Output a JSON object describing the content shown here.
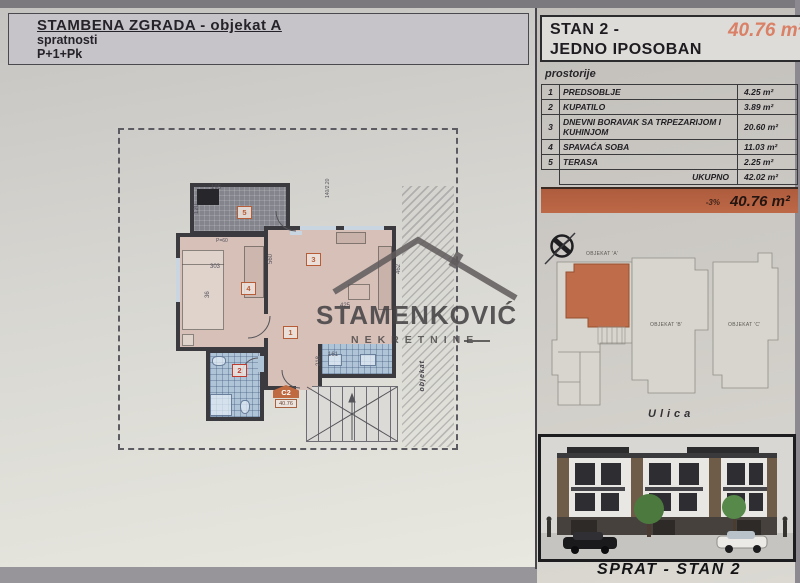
{
  "header": {
    "title": "STAMBENA ZGRADA - objekat A",
    "subtitle": "spratnosti",
    "floors": "P+1+Pk"
  },
  "unit_panel": {
    "title_line1": "STAN 2 -",
    "title_line2": "JEDNO IPOSOBAN",
    "area_highlight": "40.76 m²",
    "section_label": "prostorije",
    "rooms": [
      {
        "num": "1",
        "name": "PREDSOBLJE",
        "area": "4.25 m²"
      },
      {
        "num": "2",
        "name": "KUPATILO",
        "area": "3.89 m²"
      },
      {
        "num": "3",
        "name": "DNEVNI BORAVAK SA TRPEZARIJOM I KUHINJOM",
        "area": "20.60 m²"
      },
      {
        "num": "4",
        "name": "SPAVAĆA SOBA",
        "area": "11.03 m²"
      },
      {
        "num": "5",
        "name": "TERASA",
        "area": "2.25 m²"
      }
    ],
    "total_label": "UKUPNO",
    "total_area": "42.02 m²",
    "discount_label": "-3%",
    "discounted_area": "40.76 m²"
  },
  "site_plan": {
    "building_a": "OBJEKAT 'A'",
    "building_b": "OBJEKAT 'B'",
    "building_c": "OBJEKAT 'C'",
    "street": "Ulica"
  },
  "floor_plan": {
    "room_badges": {
      "hall": "1",
      "bathroom": "2",
      "living": "3",
      "bedroom": "4",
      "terrace": "5"
    },
    "unit_code": "C2",
    "unit_code_area": "40.76",
    "side_text": "objekat",
    "dims": {
      "d1": "195",
      "d2": "120",
      "d3": "303",
      "d4": "560",
      "d5": "462",
      "d6": "218",
      "d7": "161",
      "d8": "425",
      "d9": "140/2.20",
      "d10": "P=60",
      "d11": "36"
    }
  },
  "watermark": {
    "name": "STAMENKOVIĆ",
    "tagline": "NEKRETNINE"
  },
  "footer": {
    "caption": "SPRAT - STAN 2"
  },
  "colors": {
    "accent_orange": "#bf6444",
    "accent_light": "#d98066",
    "plan_pink": "#d7c0b8",
    "tile_blue": "#b0c4d8",
    "wall_dark": "#3a3a3f",
    "highlight_unit": "#bf6c4a"
  }
}
